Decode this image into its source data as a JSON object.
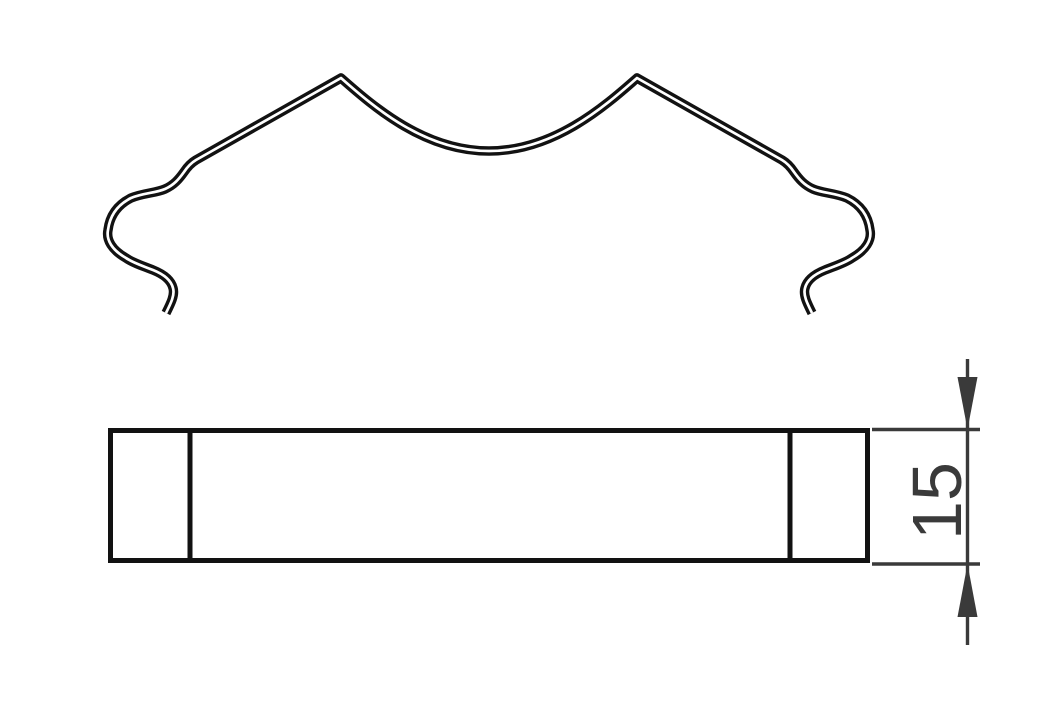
{
  "diagram": {
    "type": "technical-drawing",
    "views": [
      {
        "name": "profile-view",
        "description": "curved spring-clip wire profile"
      },
      {
        "name": "side-view",
        "description": "rectangular bar side view with two end segment lines"
      }
    ],
    "dimension": {
      "value": "15",
      "orientation": "vertical",
      "measures": "side-view height"
    }
  },
  "colors": {
    "background": "#ffffff",
    "drawing_line": "#121212",
    "dimension_line": "#3a3a3a",
    "dimension_text": "#3a3a3a"
  }
}
